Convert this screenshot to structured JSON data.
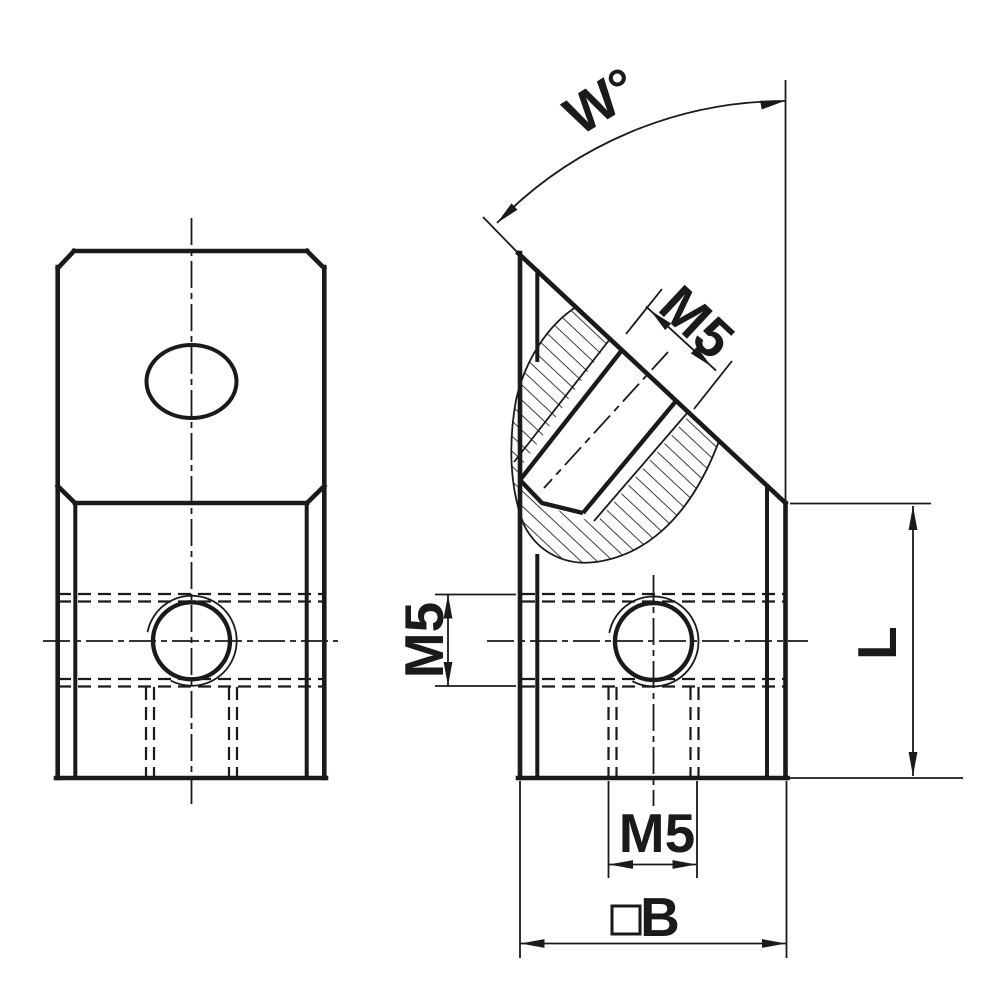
{
  "page": {
    "title": "angled-connector-technical-drawing",
    "background": "#ffffff",
    "line_color": "#1a1a1a"
  },
  "views": {
    "front_view": "front-view-of-angle-block",
    "side_view": "side-section-view-of-angle-block"
  },
  "dimensions": {
    "angle": {
      "label": "W°"
    },
    "angled_hole": {
      "label": "M5"
    },
    "side_hole": {
      "label": "M5"
    },
    "bottom_hole": {
      "label": "M5"
    },
    "length": {
      "label": "L"
    },
    "width": {
      "label": "B",
      "symbol": "square"
    }
  }
}
